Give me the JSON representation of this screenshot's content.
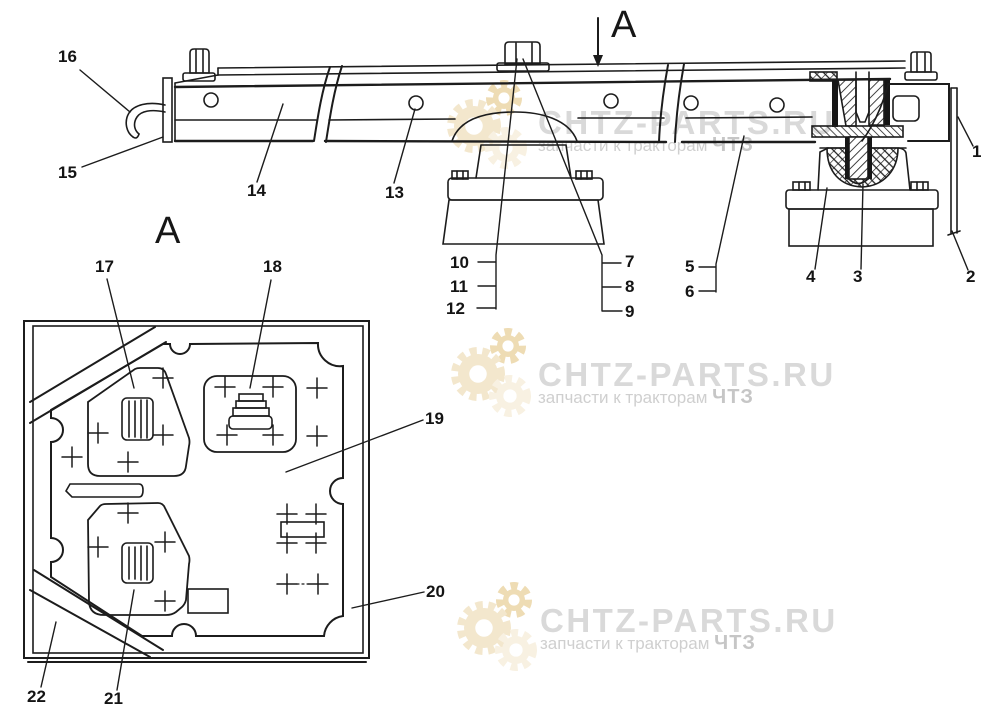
{
  "page": {
    "background": "#ffffff",
    "line_color": "#1c1c1c"
  },
  "watermark": {
    "brand": "CHTZ-PARTS.RU",
    "tagline": "запчасти к тракторам",
    "tagline_suffix": "ЧТЗ",
    "brand_color": "#d9d9d9",
    "tagline_color": "#cfcfcf",
    "gear_colors": [
      "#eedcb4",
      "#f3e7cd",
      "#f8f1e2"
    ],
    "instances": [
      {
        "x": 538,
        "y": 106,
        "gx": 474,
        "gy": 126
      },
      {
        "x": 538,
        "y": 358,
        "gx": 478,
        "gy": 374
      },
      {
        "x": 540,
        "y": 604,
        "gx": 484,
        "gy": 628
      }
    ]
  },
  "view_labels": [
    {
      "text": "A",
      "x": 611,
      "y": 6
    },
    {
      "text": "A",
      "x": 155,
      "y": 212
    }
  ],
  "callouts": [
    {
      "n": "1",
      "x": 972,
      "y": 143
    },
    {
      "n": "2",
      "x": 966,
      "y": 268
    },
    {
      "n": "3",
      "x": 853,
      "y": 268
    },
    {
      "n": "4",
      "x": 806,
      "y": 268
    },
    {
      "n": "5",
      "x": 685,
      "y": 258
    },
    {
      "n": "6",
      "x": 685,
      "y": 283
    },
    {
      "n": "7",
      "x": 625,
      "y": 253
    },
    {
      "n": "8",
      "x": 625,
      "y": 278
    },
    {
      "n": "9",
      "x": 625,
      "y": 303
    },
    {
      "n": "10",
      "x": 450,
      "y": 254
    },
    {
      "n": "11",
      "x": 450,
      "y": 278
    },
    {
      "n": "12",
      "x": 446,
      "y": 300
    },
    {
      "n": "13",
      "x": 385,
      "y": 184
    },
    {
      "n": "14",
      "x": 247,
      "y": 182
    },
    {
      "n": "15",
      "x": 58,
      "y": 164
    },
    {
      "n": "16",
      "x": 58,
      "y": 48
    },
    {
      "n": "17",
      "x": 95,
      "y": 258
    },
    {
      "n": "18",
      "x": 263,
      "y": 258
    },
    {
      "n": "19",
      "x": 425,
      "y": 410
    },
    {
      "n": "20",
      "x": 426,
      "y": 583
    },
    {
      "n": "21",
      "x": 104,
      "y": 690
    },
    {
      "n": "22",
      "x": 27,
      "y": 688
    }
  ]
}
